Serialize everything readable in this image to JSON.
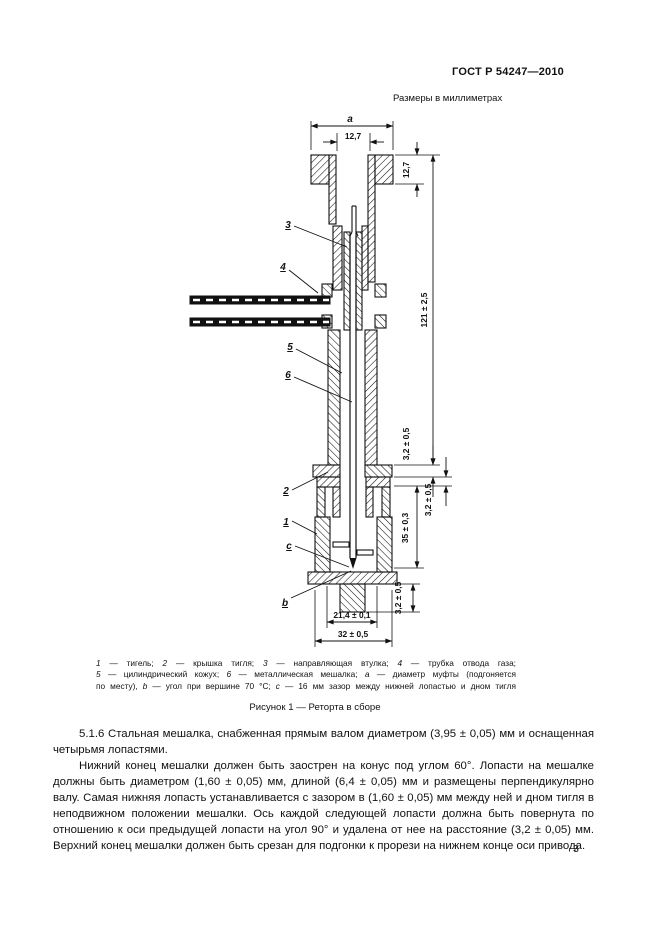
{
  "header": {
    "doc_number": "ГОСТ Р 54247—2010"
  },
  "units_note": "Размеры в миллиметрах",
  "drawing": {
    "dims": {
      "a": "a",
      "bore_width": "12,7",
      "flange_height": "12,7",
      "assembly_height": "121 ± 2,5",
      "gap_top": "3,2 ± 0,5",
      "gap_mid": "3,2 ± 0,5",
      "crucible_height": "35 ± 0,3",
      "gap_bottom": "3,2 ± 0,5",
      "plug_width": "21,4 ± 0,1",
      "crucible_width": "32 ± 0,5"
    },
    "callouts": [
      "3",
      "4",
      "5",
      "6",
      "2",
      "1",
      "c",
      "b"
    ]
  },
  "figure": {
    "caption_lines": [
      [
        {
          "t": "1",
          "i": 1
        },
        {
          "t": " — тигель;   ",
          "i": 0
        },
        {
          "t": "2",
          "i": 1
        },
        {
          "t": " — крышка тигля;   ",
          "i": 0
        },
        {
          "t": "3",
          "i": 1
        },
        {
          "t": " — направляющая втулка;   ",
          "i": 0
        },
        {
          "t": "4",
          "i": 1
        },
        {
          "t": " — трубка отвода газа;",
          "i": 0
        }
      ],
      [
        {
          "t": "5",
          "i": 1
        },
        {
          "t": " — цилиндрический кожух; ",
          "i": 0
        },
        {
          "t": "6",
          "i": 1
        },
        {
          "t": " — металлическая мешалка; ",
          "i": 0
        },
        {
          "t": "a",
          "i": 1
        },
        {
          "t": " — диаметр муфты (подгоняется",
          "i": 0
        }
      ],
      [
        {
          "t": "по месту), ",
          "i": 0
        },
        {
          "t": "b",
          "i": 1
        },
        {
          "t": " — угол при вершине 70 °С; ",
          "i": 0
        },
        {
          "t": "c",
          "i": 1
        },
        {
          "t": " — 16 мм зазор между нижней лопастью и дном тигля",
          "i": 0
        }
      ]
    ],
    "title": "Рисунок 1 — Реторта в сборе"
  },
  "body": {
    "para1": "5.1.6  Стальная мешалка, снабженная прямым валом диаметром (3,95 ± 0,05) мм и оснащенная четырьмя лопастями.",
    "para2": "Нижний конец мешалки должен быть заострен на конус под углом 60°. Лопасти на мешалке должны быть диаметром (1,60 ± 0,05) мм, длиной (6,4 ± 0,05) мм и размещены перпендикулярно валу. Самая нижняя лопасть устанавливается с зазором в (1,60 ± 0,05) мм между ней и дном тигля в неподвижном положении мешалки. Ось каждой следующей лопасти должна быть повернута по отношению к оси предыдущей лопасти на угол 90° и удалена от нее на расстояние (3,2 ± 0,05) мм. Верхний конец мешалки должен быть срезан для подгонки к прорези на нижнем конце оси привода."
  },
  "page_number": "3"
}
